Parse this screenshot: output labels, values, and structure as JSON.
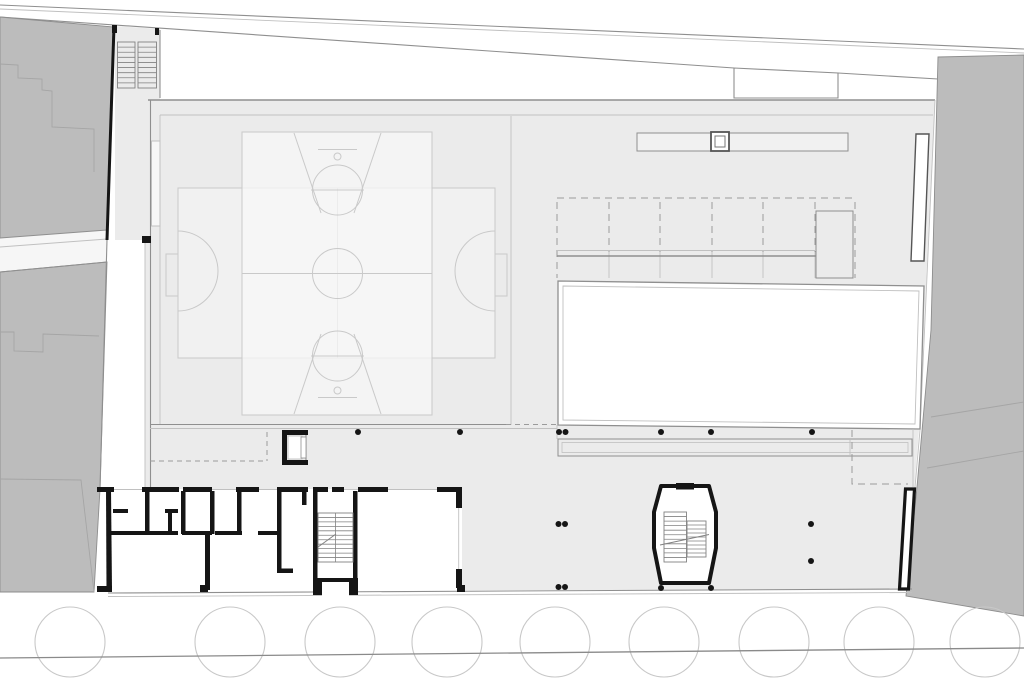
{
  "palette": {
    "bg": "#ffffff",
    "neighbor": "#bcbcbc",
    "neighborLine": "#8d8d8d",
    "neighborInner": "#a5a5a5",
    "alley": "#f6f6f6",
    "floor": "#ebebeb",
    "courtA": "#f1f1f1",
    "courtB": "#f7f7f7",
    "courtLine": "#c9c9c9",
    "wall": "#151515",
    "line": "#8f8f8f",
    "lightLine": "#c0c0c0",
    "dashLine": "#9b9b9b",
    "stairLine": "#828282",
    "treeLine": "#c8c8c8",
    "street": "#8a8a8a"
  },
  "site": {
    "trees": {
      "cy": 642,
      "r": 35,
      "cx": [
        70,
        230,
        340,
        447,
        555,
        664,
        774,
        879,
        985
      ]
    },
    "street_line": {
      "x1": 0,
      "y1": 658,
      "x2": 1024,
      "y2": 648
    }
  },
  "structure": {
    "columns": {
      "r": 3,
      "points": [
        [
          358,
          432
        ],
        [
          460,
          432
        ],
        [
          559,
          432
        ],
        [
          565.5,
          432
        ],
        [
          661,
          432
        ],
        [
          711,
          432
        ],
        [
          812,
          432
        ],
        [
          558.5,
          524
        ],
        [
          565,
          524
        ],
        [
          811,
          524
        ],
        [
          811,
          561
        ],
        [
          558.5,
          587
        ],
        [
          565,
          587
        ],
        [
          661,
          588
        ],
        [
          711,
          588
        ]
      ]
    },
    "bleachers": {
      "y1": 198,
      "ymid": 252,
      "y2": 278,
      "cols": [
        609,
        660,
        712,
        763,
        815
      ]
    },
    "stairs": [
      {
        "target": "entry-stairs",
        "x": 117.5,
        "y": 42,
        "w": 17.5,
        "h": 46,
        "treads": 9
      },
      {
        "target": "entry-stairs",
        "x": 138,
        "y": 42,
        "w": 18.5,
        "h": 46,
        "treads": 9
      },
      {
        "target": "service-stair-treads",
        "x": 318,
        "y": 513,
        "w": 35,
        "h": 49,
        "treads": 11,
        "rail": true
      },
      {
        "target": "hall-stair-treads",
        "x": 664,
        "y": 512,
        "w": 22.5,
        "h": 50,
        "treads": 11
      },
      {
        "target": "hall-stair-treads",
        "x": 687,
        "y": 521,
        "w": 19,
        "h": 36,
        "treads": 9
      }
    ]
  }
}
